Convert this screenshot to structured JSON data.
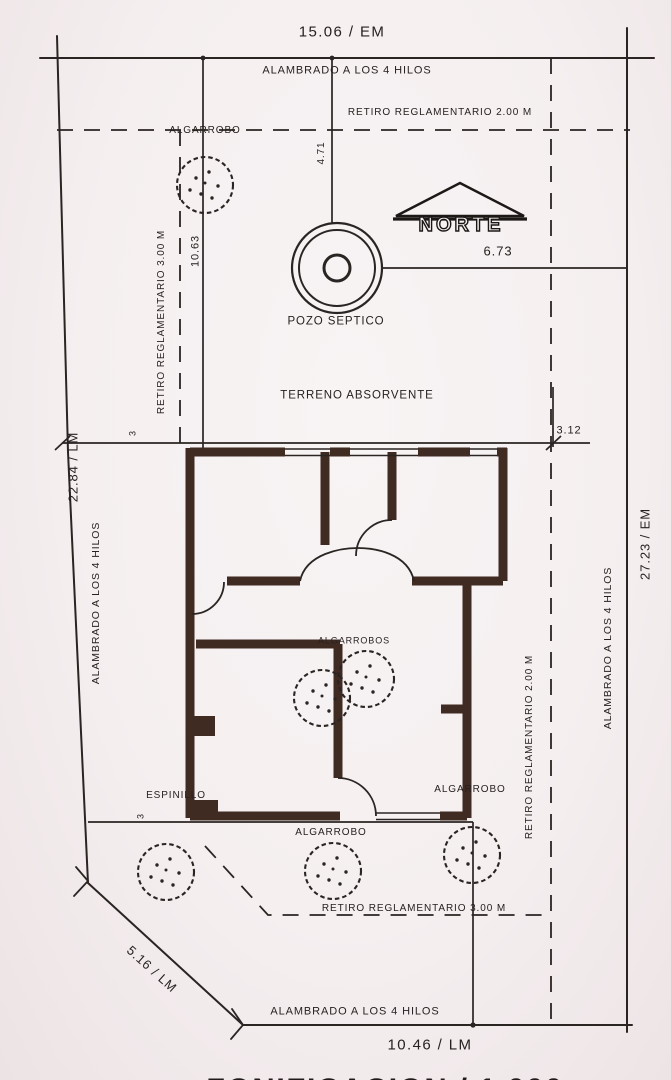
{
  "plan": {
    "scale_title": "ZONIFICACION / 1.000",
    "north": {
      "label": "NORTE"
    },
    "boundary": {
      "top": {
        "dimension": "15.06 / EM",
        "fence": "ALAMBRADO A LOS 4 HILOS"
      },
      "left": {
        "dimension": "22.84 / LM",
        "fence": "ALAMBRADO A LOS 4 HILOS"
      },
      "right": {
        "dimension": "27.23 / EM",
        "fence": "ALAMBRADO A LOS 4 HILOS"
      },
      "bottom": {
        "dimension": "10.46 / LM",
        "fence": "ALAMBRADO A LOS 4 HILOS"
      },
      "corner": {
        "dimension": "5.16 / LM"
      }
    },
    "setbacks": {
      "top": "RETIRO REGLAMENTARIO 2.00 M",
      "left": "RETIRO REGLAMENTARIO 3.00 M",
      "right": "RETIRO REGLAMENTARIO 2.00 M",
      "bottom": "RETIRO REGLAMENTARIO 3.00 M"
    },
    "dimensions": {
      "well_to_fence": "4.71",
      "well_to_east": "6.73",
      "house_to_west": "10.63",
      "house_to_east": "3.12",
      "west_setback_tick": "3",
      "south_setback_tick": "3"
    },
    "features": {
      "septic_well": "POZO SEPTICO",
      "absorbent_terrain": "TERRENO ABSORVENTE"
    },
    "trees": {
      "northwest": "ALGARROBO",
      "courtyard": "ALGARROBOS",
      "southwest": "ESPINILLO",
      "south_center": "ALGARROBO",
      "southeast": "ALGARROBO"
    },
    "colors": {
      "paper": "#f5eff0",
      "ink": "#2a2422",
      "wall": "#402b23"
    }
  }
}
